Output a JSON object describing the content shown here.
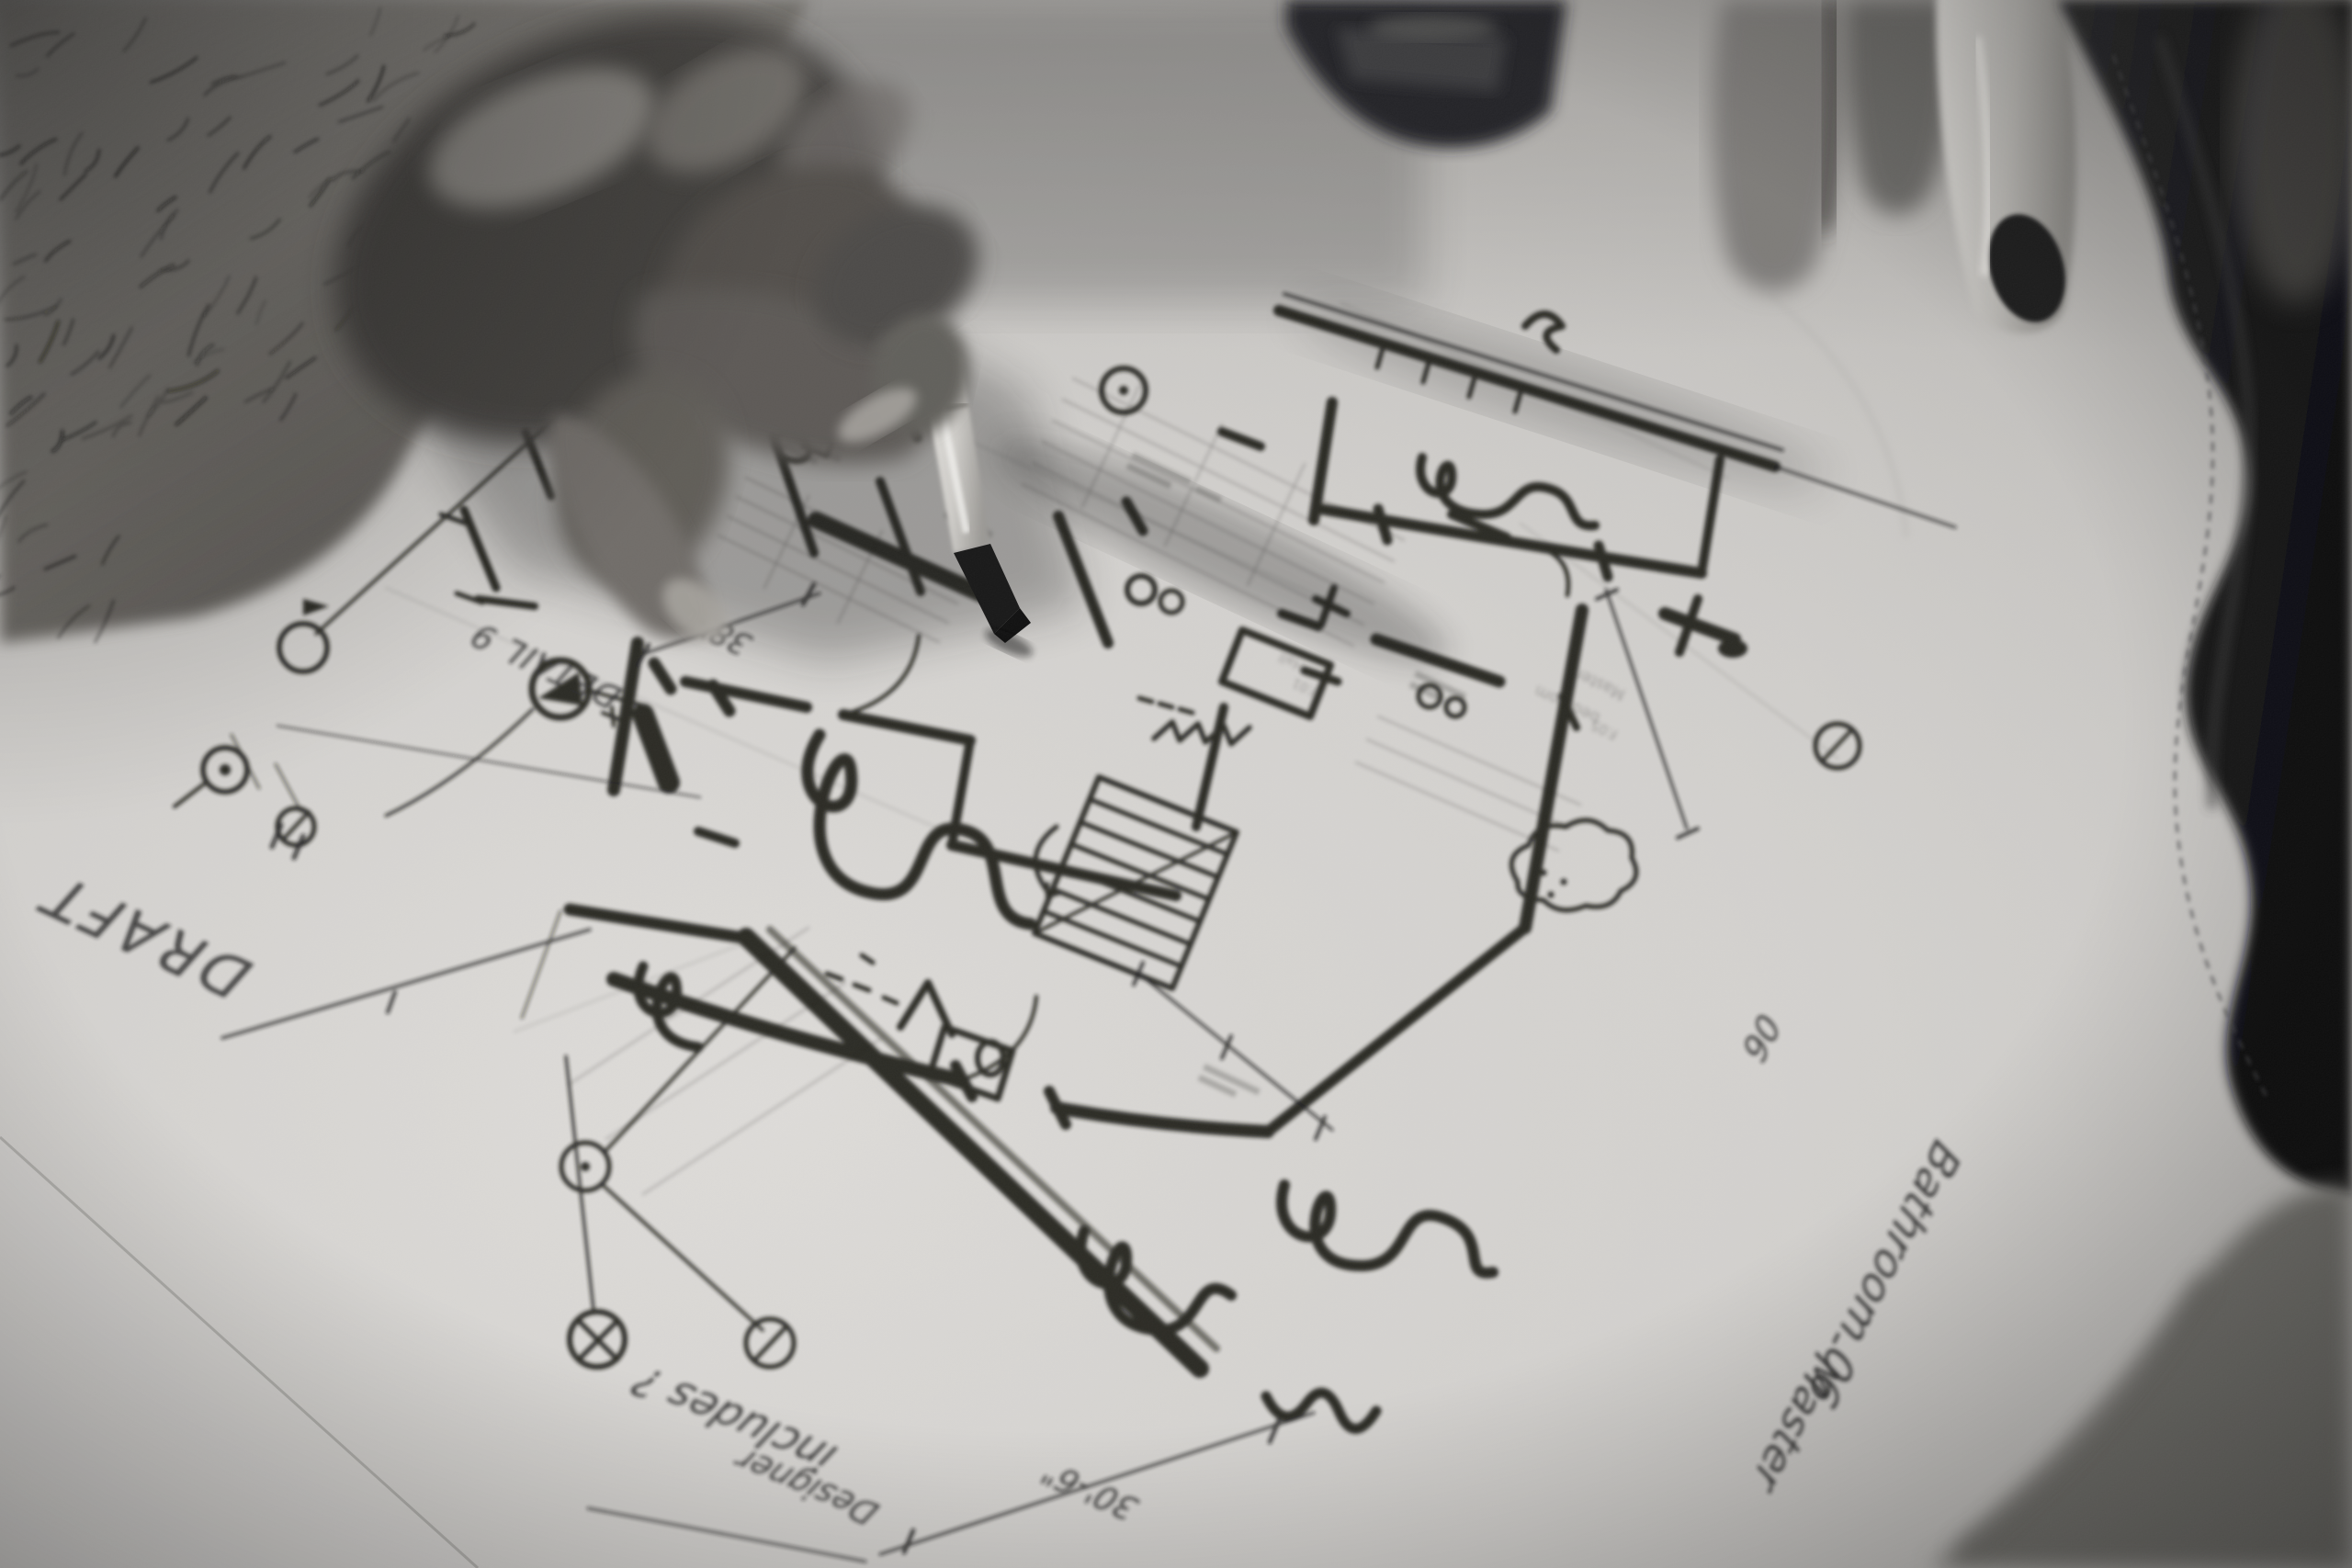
{
  "scene": {
    "description": "Black-and-white close-up photograph of a hand drawing a residential floor plan with a chisel-tip marker on trace paper laid over a printed plan",
    "medium": "black-and-white photograph",
    "subject": "architect sketching a floor plan by hand"
  },
  "annotations": {
    "draft_stamp": "DRAFT",
    "detail_callout": "DETAIL 9",
    "dimension_width": "38'-0\"",
    "dimension_total": "30'-6\"",
    "margin_note_line1": "includes ?",
    "margin_note_line2": "Designer",
    "room_note_line1": "Bathroom 06",
    "room_note_line2": "- Master",
    "scribbled_number": "06"
  },
  "underlay_labels": {
    "room_a": "Master",
    "room_b": "bedroom",
    "room_c": "F.05",
    "room_d": "Hall",
    "room_e": "F.01"
  },
  "palette": {
    "paper": "#c6c4c1",
    "ink": "#1a1a19",
    "pencil": "#5a5855",
    "skin_highlight": "#a09d98",
    "skin_shadow": "#45433f",
    "leather": "#151517",
    "marker_barrel": "#dedcd8",
    "marker_tip": "#111111"
  }
}
